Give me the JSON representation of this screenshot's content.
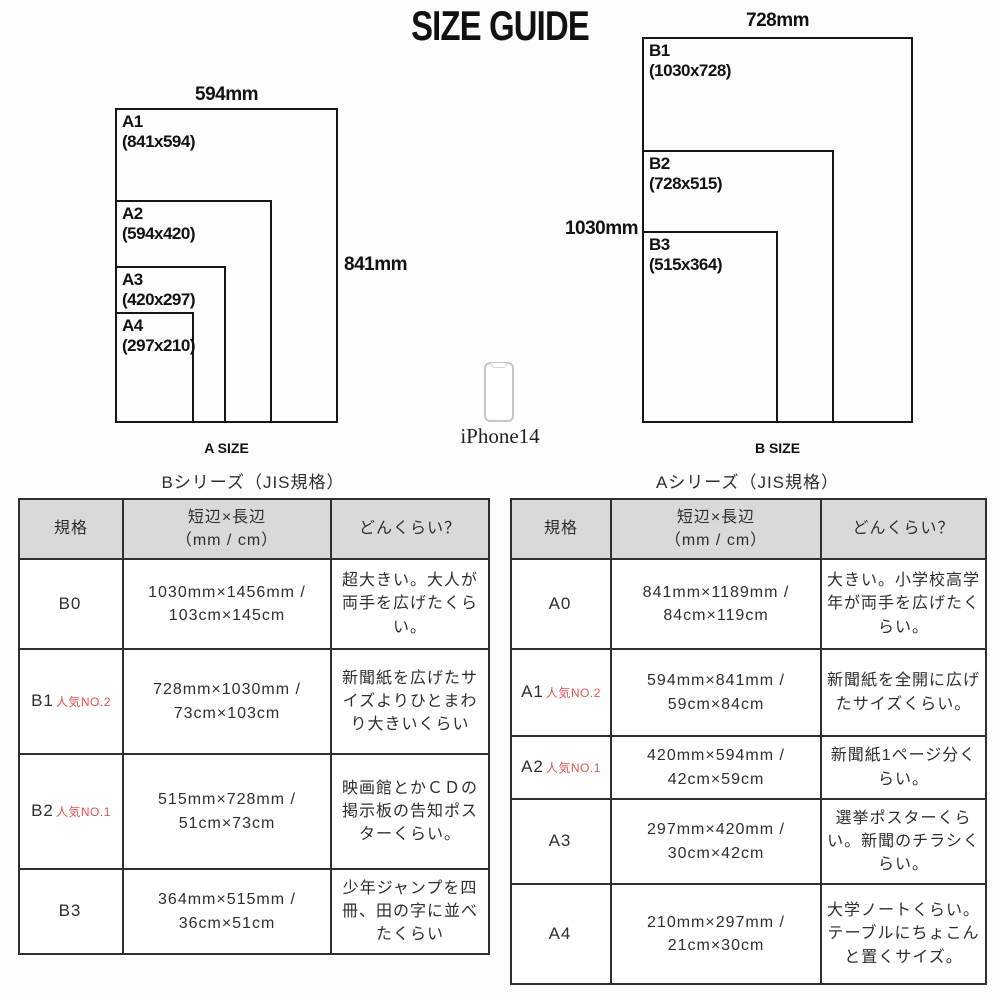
{
  "title": "SIZE GUIDE",
  "diagrams": {
    "a": {
      "caption": "A SIZE",
      "width_label": "594mm",
      "height_label": "841mm",
      "papers": [
        {
          "name": "A1",
          "dims": "(841x594)"
        },
        {
          "name": "A2",
          "dims": "(594x420)"
        },
        {
          "name": "A3",
          "dims": "(420x297)"
        },
        {
          "name": "A4",
          "dims": "(297x210)"
        }
      ]
    },
    "b": {
      "caption": "B SIZE",
      "width_label": "728mm",
      "height_label": "1030mm",
      "papers": [
        {
          "name": "B1",
          "dims": "(1030x728)"
        },
        {
          "name": "B2",
          "dims": "(728x515)"
        },
        {
          "name": "B3",
          "dims": "(515x364)"
        }
      ]
    },
    "phone_label": "iPhone14"
  },
  "tables": {
    "b": {
      "title": "Bシリーズ（JIS規格）",
      "headers": {
        "col1": "規格",
        "col2_line1": "短辺×長辺",
        "col2_line2": "（mm / cm）",
        "col3": "どんくらい？"
      },
      "rows": [
        {
          "size": "B0",
          "badge": "",
          "dims": "1030mm×1456mm / 103cm×145cm",
          "desc": "超大きい。大人が両手を広げたくらい。"
        },
        {
          "size": "B1",
          "badge": "人気NO.2",
          "dims": "728mm×1030mm / 73cm×103cm",
          "desc": "新聞紙を広げたサイズよりひとまわり大きいくらい"
        },
        {
          "size": "B2",
          "badge": "人気NO.1",
          "dims": "515mm×728mm / 51cm×73cm",
          "desc": "映画館とかＣＤの掲示板の告知ポスターくらい。"
        },
        {
          "size": "B3",
          "badge": "",
          "dims": "364mm×515mm / 36cm×51cm",
          "desc": "少年ジャンプを四冊、田の字に並べたくらい"
        }
      ]
    },
    "a": {
      "title": "Aシリーズ（JIS規格）",
      "headers": {
        "col1": "規格",
        "col2_line1": "短辺×長辺",
        "col2_line2": "（mm / cm）",
        "col3": "どんくらい？"
      },
      "rows": [
        {
          "size": "A0",
          "badge": "",
          "dims": "841mm×1189mm / 84cm×119cm",
          "desc": "大きい。小学校高学年が両手を広げたくらい。"
        },
        {
          "size": "A1",
          "badge": "人気NO.2",
          "dims": "594mm×841mm / 59cm×84cm",
          "desc": "新聞紙を全開に広げたサイズくらい。"
        },
        {
          "size": "A2",
          "badge": "人気NO.1",
          "dims": "420mm×594mm / 42cm×59cm",
          "desc": "新聞紙1ページ分くらい。"
        },
        {
          "size": "A3",
          "badge": "",
          "dims": "297mm×420mm / 30cm×42cm",
          "desc": "選挙ポスターくらい。新聞のチラシくらい。"
        },
        {
          "size": "A4",
          "badge": "",
          "dims": "210mm×297mm / 21cm×30cm",
          "desc": "大学ノートくらい。テーブルにちょこんと置くサイズ。"
        }
      ]
    }
  },
  "colors": {
    "accent_red": "#e0534c",
    "header_bg": "#d9d9d9",
    "table_border": "#2f2f2f",
    "line": "#161616"
  }
}
